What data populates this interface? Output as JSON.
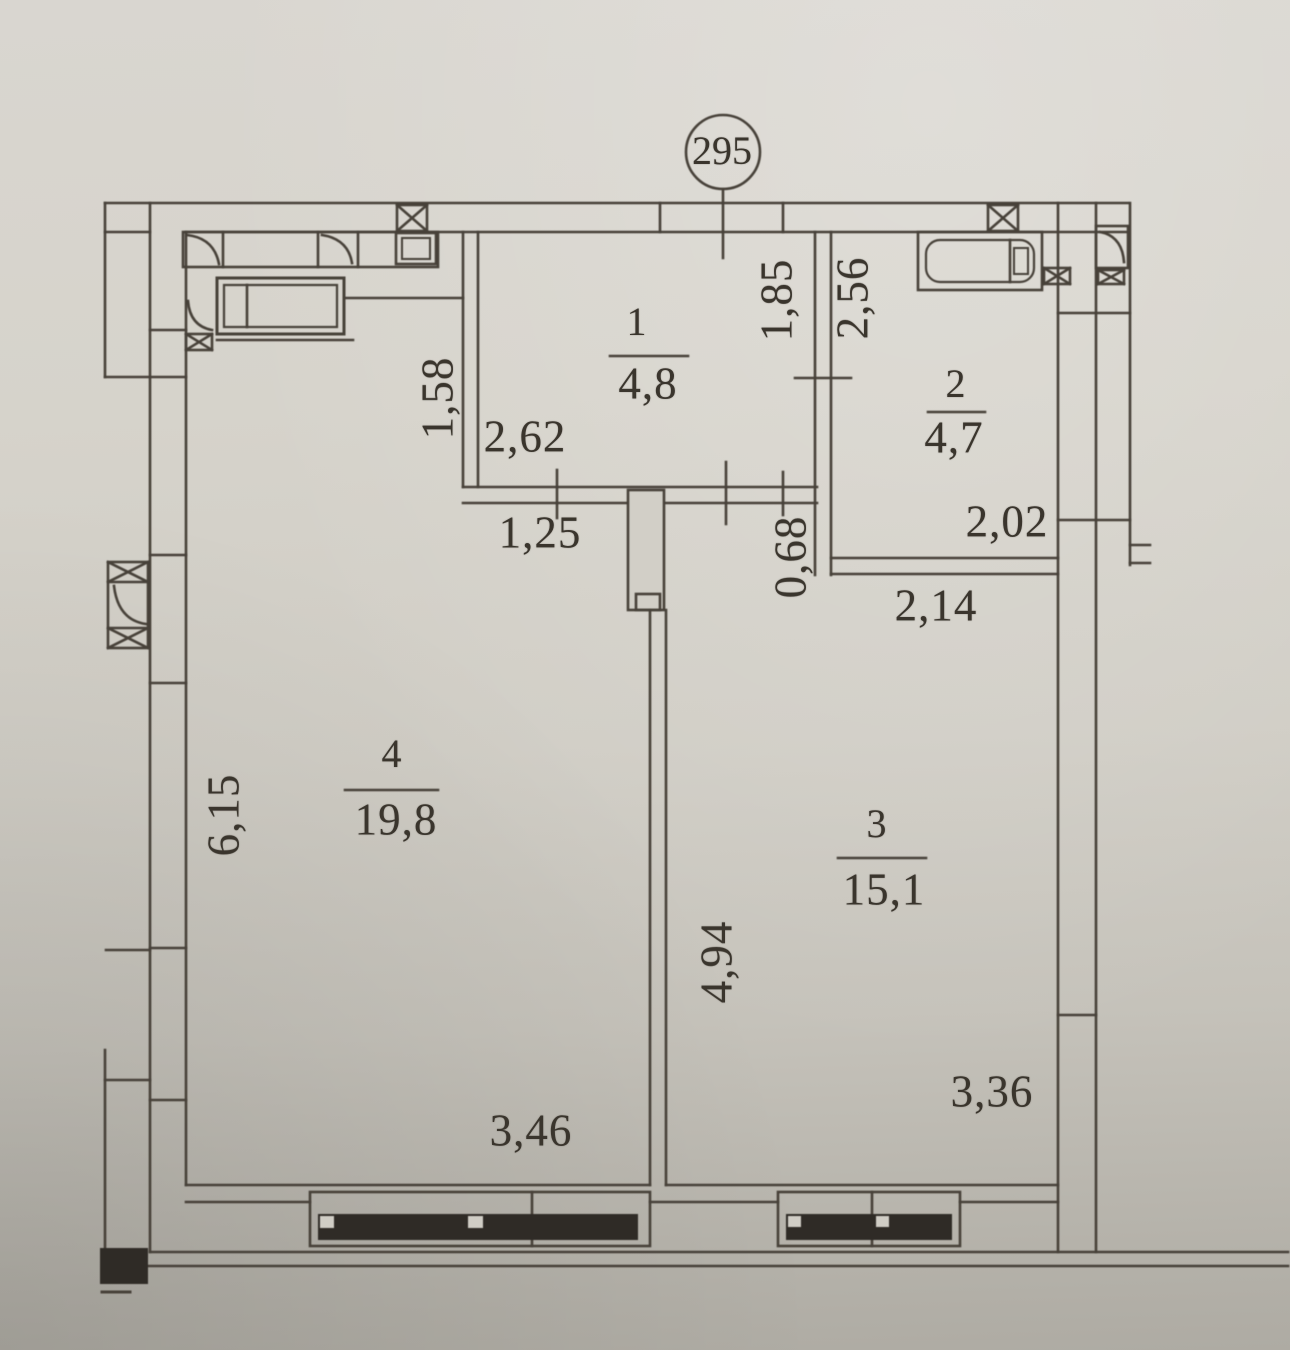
{
  "plan": {
    "axis_marker": {
      "label": "295"
    },
    "rooms": [
      {
        "number": "1",
        "area": "4,8"
      },
      {
        "number": "2",
        "area": "4,7"
      },
      {
        "number": "3",
        "area": "15,1"
      },
      {
        "number": "4",
        "area": "19,8"
      }
    ],
    "dimensions": {
      "d185": "1,85",
      "d256": "2,56",
      "d262": "2,62",
      "d158": "1,58",
      "d125": "1,25",
      "d068": "0,68",
      "d202": "2,02",
      "d214": "2,14",
      "d615": "6,15",
      "d494": "4,94",
      "d346": "3,46",
      "d336": "3,36"
    },
    "colors": {
      "paper": "#d5d2ca",
      "ink": "#474139"
    }
  }
}
